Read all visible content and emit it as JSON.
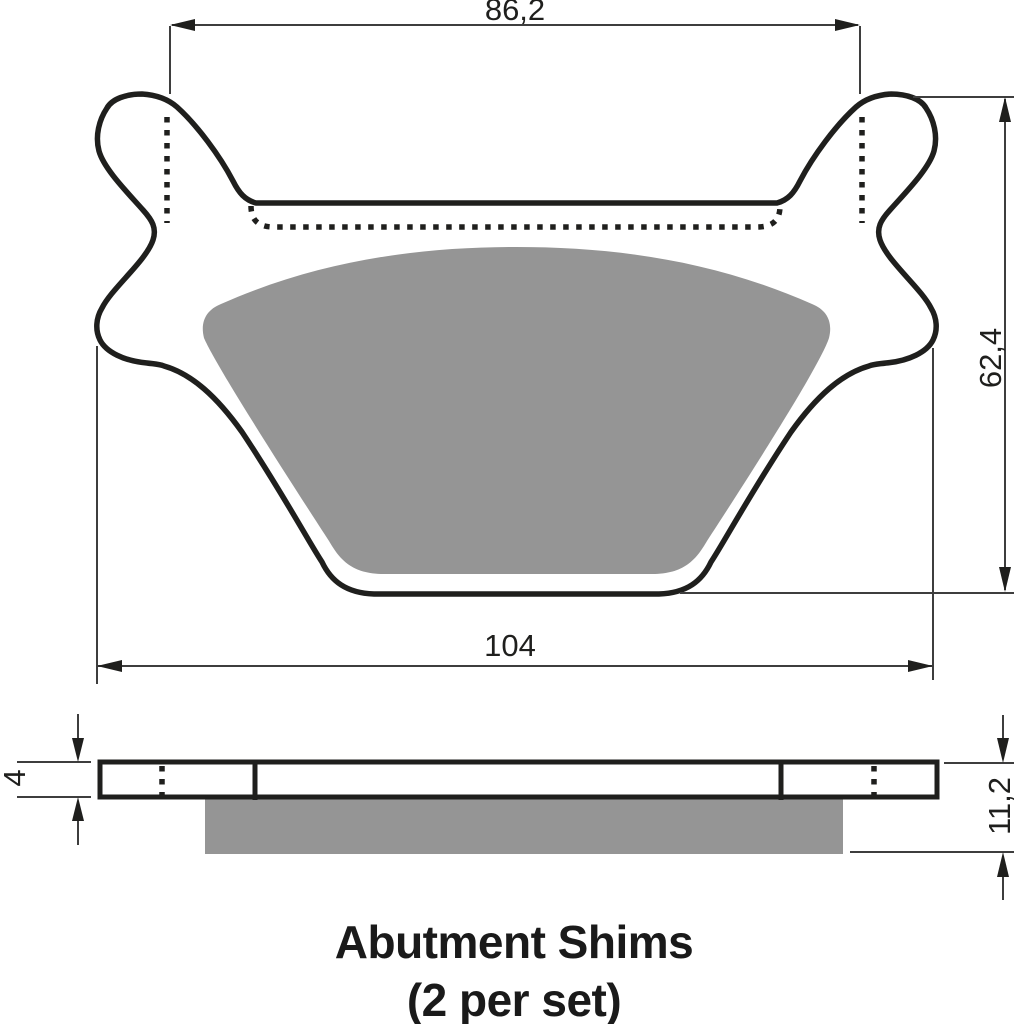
{
  "figure": {
    "caption": {
      "line1": "Abutment Shims",
      "line2": "(2 per set)"
    },
    "dimensions": {
      "top_width": "86,2",
      "bottom_width": "104",
      "overall_height": "62,4",
      "shim_thickness": "4",
      "total_thickness": "11,2"
    },
    "colors": {
      "outline": "#1f1f1d",
      "friction_pad_fill": "#959595",
      "dimension_lines": "#3e3e3e",
      "text": "#1f1f1d",
      "background": "#ffffff"
    }
  }
}
